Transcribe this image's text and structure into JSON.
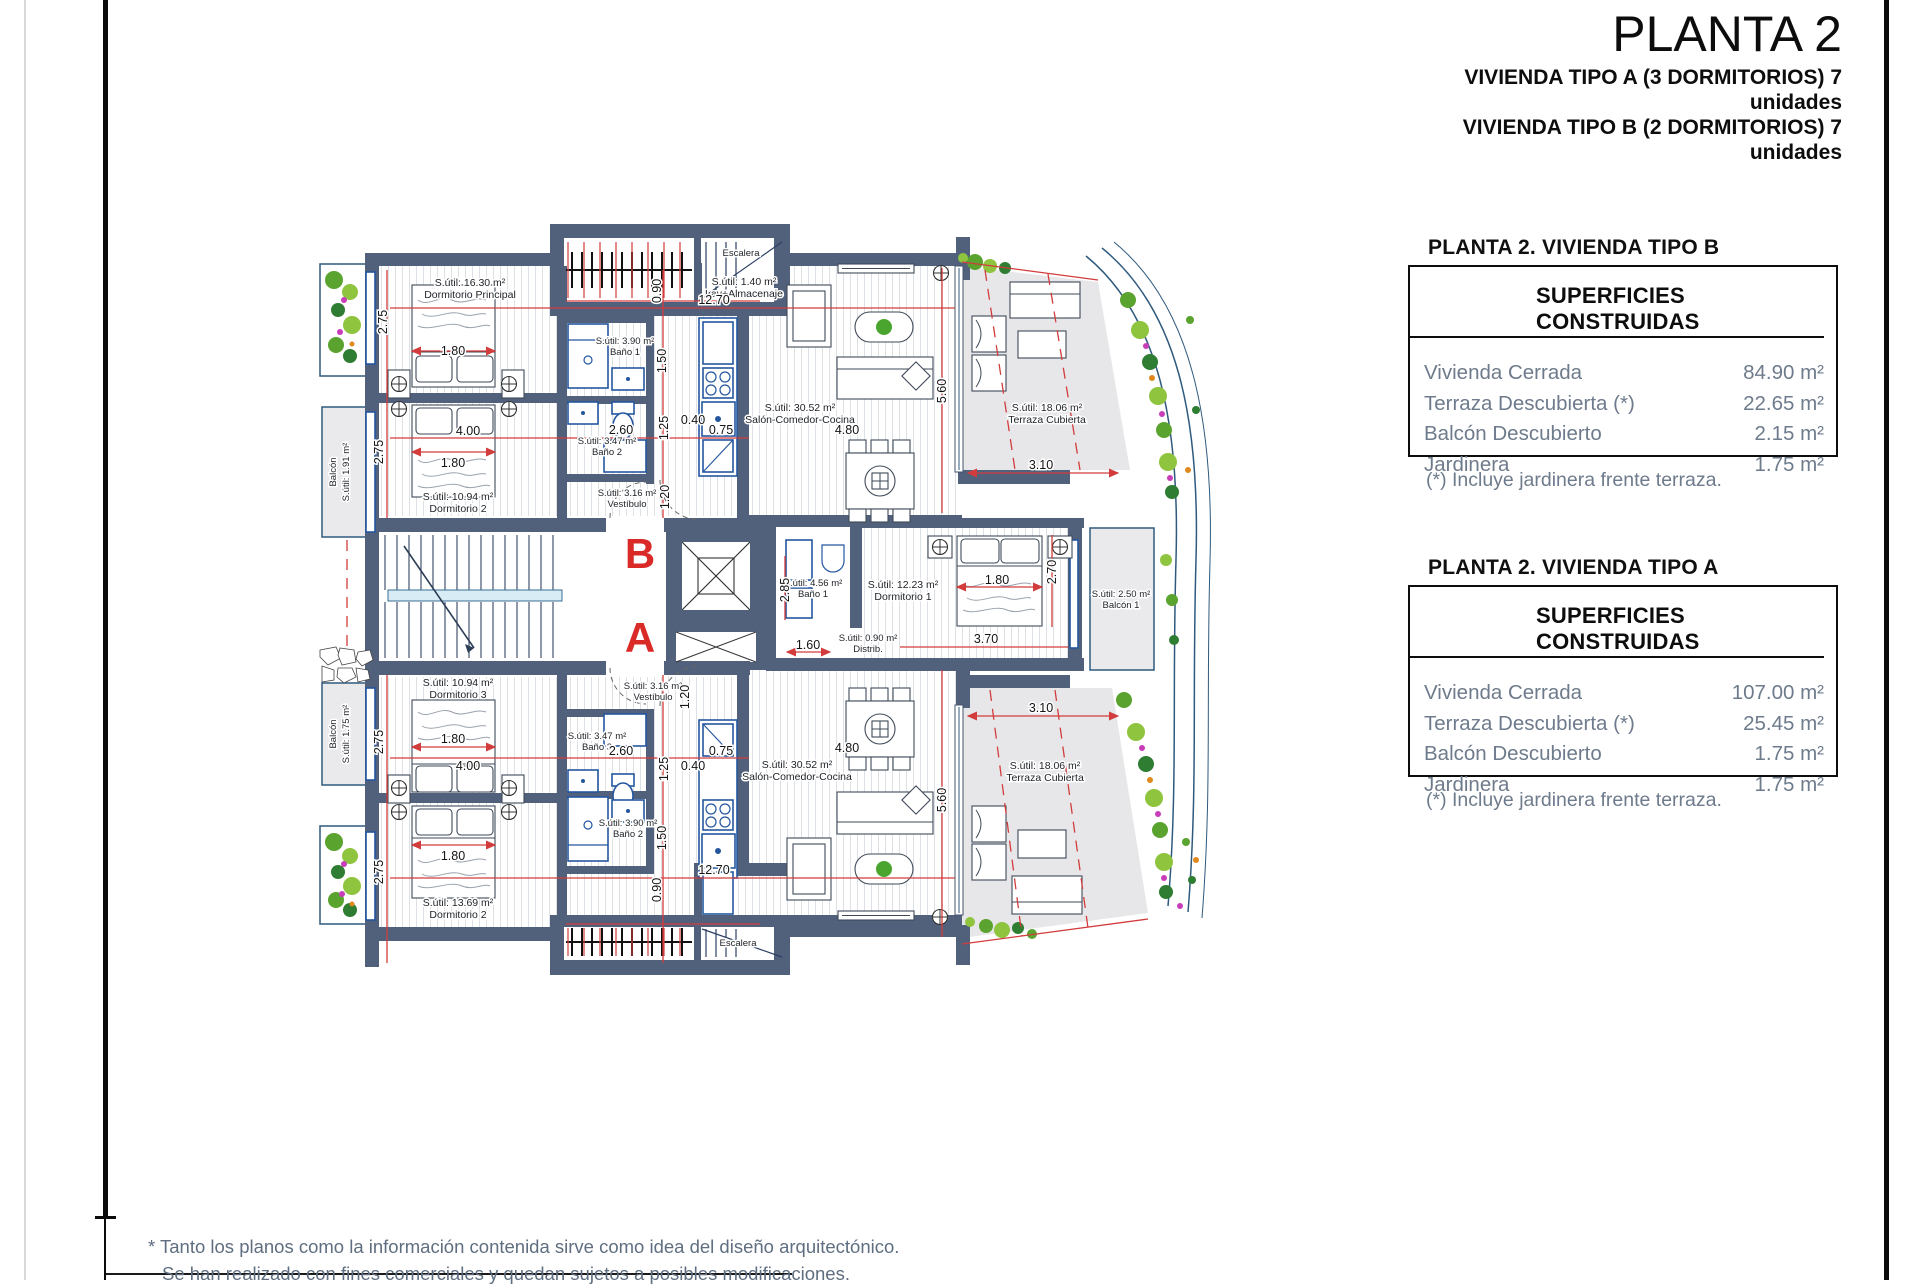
{
  "header": {
    "title": "PLANTA 2",
    "subtitle1": "VIVIENDA TIPO A (3 DORMITORIOS) 7 unidades",
    "subtitle2": "VIVIENDA TIPO B (2 DORMITORIOS) 7 unidades"
  },
  "tables": {
    "tipo_b": {
      "heading": "PLANTA 2. VIVIENDA TIPO B",
      "box_title": "SUPERFICIES CONSTRUIDAS",
      "rows": [
        {
          "label": "Vivienda Cerrada",
          "value": "84.90 m²"
        },
        {
          "label": "Terraza Descubierta (*)",
          "value": "22.65 m²"
        },
        {
          "label": "Balcón Descubierto",
          "value": "2.15 m²"
        },
        {
          "label": "Jardinera",
          "value": "1.75 m²"
        }
      ],
      "footnote": "(*) Incluye jardinera frente terraza."
    },
    "tipo_a": {
      "heading": "PLANTA 2. VIVIENDA TIPO A",
      "box_title": "SUPERFICIES CONSTRUIDAS",
      "rows": [
        {
          "label": "Vivienda Cerrada",
          "value": "107.00 m²"
        },
        {
          "label": "Terraza Descubierta (*)",
          "value": "25.45 m²"
        },
        {
          "label": "Balcón Descubierto",
          "value": "1.75 m²"
        },
        {
          "label": "Jardinera",
          "value": "1.75 m²"
        }
      ],
      "footnote": "(*) Incluye jardinera frente terraza."
    }
  },
  "footer": {
    "line1": "* Tanto los planos como la información contenida sirve como idea del diseño arquitectónico.",
    "line2": "Se han realizado con fines comerciales y quedan sujetos a posibles modificaciones."
  },
  "plan": {
    "unit_b": "B",
    "unit_a": "A",
    "rooms": [
      {
        "l1": "S.útil: 16.30 m²",
        "l2": "Dormitorio Principal"
      },
      {
        "l1": "S.útil: 1.40 m²",
        "l2": "Lav+Almacenaje"
      },
      {
        "l1": "Escalera",
        "l2": ""
      },
      {
        "l1": "S.útil: 3.90 m²",
        "l2": "Baño 1"
      },
      {
        "l1": "S.útil: 3.47 m²",
        "l2": "Baño 2"
      },
      {
        "l1": "S.útil: 10.94 m²",
        "l2": "Dormitorio 2"
      },
      {
        "l1": "S.útil: 3.16 m²",
        "l2": "Vestíbulo"
      },
      {
        "l1": "S.útil: 30.52 m²",
        "l2": "Salón-Comedor-Cocina"
      },
      {
        "l1": "S.útil: 18.06 m²",
        "l2": "Terraza Cubierta"
      },
      {
        "l1": "Balcón",
        "l2": "S.útil: 1.91 m²"
      },
      {
        "l1": "S.útil: 4.56 m²",
        "l2": "Baño 1"
      },
      {
        "l1": "S.útil: 12.23 m²",
        "l2": "Dormitorio 1"
      },
      {
        "l1": "S.útil: 0.90 m²",
        "l2": "Distrib."
      },
      {
        "l1": "S.útil: 2.50 m²",
        "l2": "Balcón 1"
      },
      {
        "l1": "S.útil: 10.94 m²",
        "l2": "Dormitorio 3"
      },
      {
        "l1": "S.útil: 3.16 m²",
        "l2": "Vestíbulo"
      },
      {
        "l1": "S.útil: 3.47 m²",
        "l2": "Baño 3"
      },
      {
        "l1": "S.útil: 3.90 m²",
        "l2": "Baño 2"
      },
      {
        "l1": "S.útil: 13.69 m²",
        "l2": "Dormitorio 2"
      },
      {
        "l1": "S.útil: 30.52 m²",
        "l2": "Salón-Comedor-Cocina"
      },
      {
        "l1": "S.útil: 18.06 m²",
        "l2": "Terraza Cubierta"
      },
      {
        "l1": "Balcón",
        "l2": "S.útil: 1.75 m²"
      },
      {
        "l1": "Escalera",
        "l2": ""
      }
    ],
    "dims": [
      "2.75",
      "1.80",
      "12.70",
      "0.90",
      "1.50",
      "4.00",
      "1.80",
      "2.60",
      "1.25",
      "0.40",
      "0.75",
      "2.75",
      "1.20",
      "5.60",
      "4.80",
      "3.10",
      "2.85",
      "1.80",
      "2.70",
      "1.60",
      "3.70",
      "1.20",
      "2.75",
      "1.80",
      "4.00",
      "2.60",
      "1.25",
      "0.40",
      "0.75",
      "1.50",
      "1.80",
      "2.75",
      "12.70",
      "0.90",
      "5.60",
      "4.80",
      "3.10"
    ],
    "colors": {
      "wall": "#52617b",
      "dim": "#d23c3c",
      "terrace": "#e7e7e9",
      "fixture": "#2456a0",
      "unit": "#da2a27",
      "muted": "#6e7b8c",
      "muted2": "#5f6e80",
      "band": "#2f5a7e"
    }
  }
}
